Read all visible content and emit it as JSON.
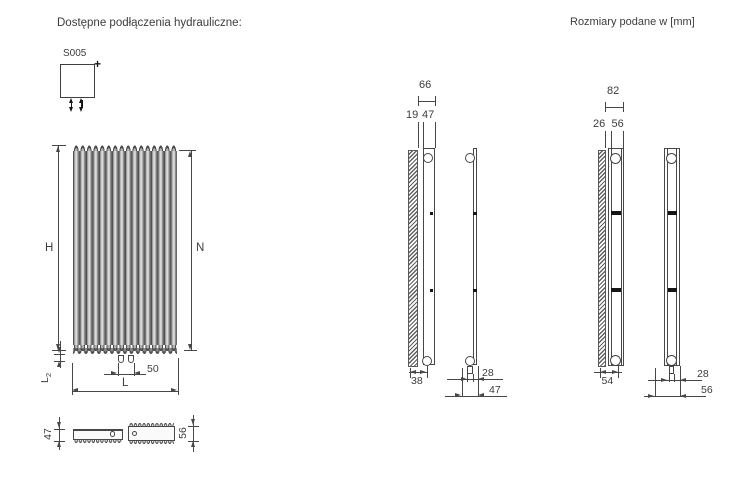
{
  "header": {
    "title": "Dostępne podłączenia hydrauliczne:",
    "units_note": "Rozmiary podane w [mm]"
  },
  "hydraulic_connection": {
    "code": "S005",
    "plus_mark": "+"
  },
  "front_view": {
    "dim_height": "H",
    "dim_tube_length": "N",
    "dim_width": "L",
    "dim_bottom_offset_main": "L",
    "dim_bottom_offset_sub": "2",
    "dim_pipe_spacing": "50"
  },
  "top_view": {
    "dim_depth_single": "47",
    "dim_depth_double": "56"
  },
  "side_view_single_row": {
    "dim_total_from_wall": "66",
    "dim_wall_clearance": "19",
    "dim_radiator_depth": "47",
    "dim_wall_to_pipe": "38",
    "dim_pipe_to_front": "28",
    "dim_depth_overall": "47"
  },
  "side_view_double_row": {
    "dim_total_from_wall": "82",
    "dim_wall_clearance": "26",
    "dim_radiator_depth": "56",
    "dim_wall_to_pipe": "54",
    "dim_pipe_to_front": "28",
    "dim_depth_overall": "56"
  },
  "colors": {
    "line": "#474747",
    "text": "#3d3d3d",
    "accent_black": "#151515"
  }
}
